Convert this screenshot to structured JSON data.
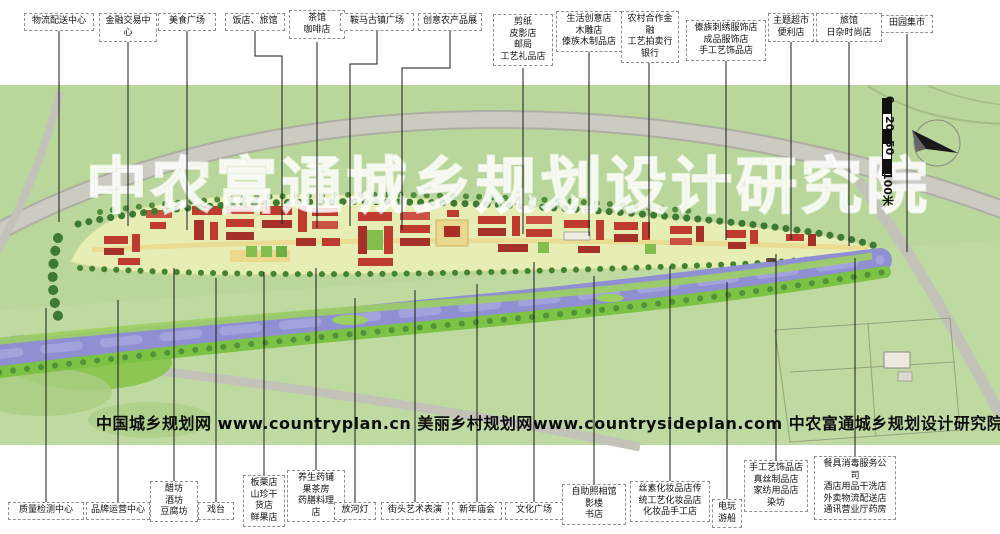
{
  "watermark": "中农富通城乡规划设计研究院",
  "credit": "中国城乡规划网 www.countryplan.cn  美丽乡村规划网www.countrysideplan.com  中农富通城乡规划设计研究院",
  "scale_bar": {
    "ticks": [
      "0",
      "20",
      "50",
      "100米"
    ]
  },
  "colors": {
    "map_green": "#b9d69b",
    "river_blue": "#8f8fd2",
    "building_red": "#bf3a2f",
    "road_gray": "#c9c9c0",
    "bank_green": "#7cc244"
  },
  "labels_top": [
    {
      "id": "logistics-center",
      "text": "物流配送中心"
    },
    {
      "id": "finance-trade-center",
      "text": "金融交易中心"
    },
    {
      "id": "food-plaza",
      "text": "美食广场"
    },
    {
      "id": "restaurant-hotel",
      "text": "饭店、旅馆"
    },
    {
      "id": "teahouse-cafe",
      "text": "茶馆\n咖啡店"
    },
    {
      "id": "ancient-town-plaza",
      "text": "鞍马古镇广场"
    },
    {
      "id": "creative-agri-expo",
      "text": "创意农产品展"
    },
    {
      "id": "papercut-shadow-shops",
      "text": "剪纸\n皮影店\n邮局\n工艺礼品店"
    },
    {
      "id": "life-creative-shops",
      "text": "生活创意店\n木雕店\n傣族木制品店"
    },
    {
      "id": "rural-finance-bank",
      "text": "农村合作金融\n工艺拍卖行\n银行"
    },
    {
      "id": "dai-embroidery-shops",
      "text": "傣族刺绣服饰店\n成品服饰店\n手工艺饰品店"
    },
    {
      "id": "theme-supermarket",
      "text": "主题超市\n便利店"
    },
    {
      "id": "hotel-daily-fashion",
      "text": "旅馆\n日杂时尚店"
    },
    {
      "id": "countryside-market",
      "text": "田园集市"
    }
  ],
  "labels_bottom": [
    {
      "id": "quality-inspection-center",
      "text": "质量检测中心"
    },
    {
      "id": "brand-operation-center",
      "text": "品牌运营中心"
    },
    {
      "id": "vinegar-wine-tofu-workshops",
      "text": "醋坊\n酒坊\n豆腐坊"
    },
    {
      "id": "opera-stage",
      "text": "戏台"
    },
    {
      "id": "chestnut-dried-goods-shops",
      "text": "板栗店\n山珍干\n货店\n鲜果店"
    },
    {
      "id": "herbal-health-shops",
      "text": "养生药铺\n果茶房\n药膳料理\n店"
    },
    {
      "id": "river-lanterns",
      "text": "放河灯"
    },
    {
      "id": "street-art-performance",
      "text": "街头艺术表演"
    },
    {
      "id": "new-year-temple-fair",
      "text": "新年庙会"
    },
    {
      "id": "culture-plaza",
      "text": "文化广场"
    },
    {
      "id": "photo-studio-bookstore",
      "text": "自助照相馆\n影楼\n书店"
    },
    {
      "id": "silk-cosmetics-shops",
      "text": "丝素化妆品店传\n统工艺化妆品店\n化妆品手工店"
    },
    {
      "id": "arcade-boats",
      "text": "电玩\n游船"
    },
    {
      "id": "handicraft-silk-shops",
      "text": "手工艺饰品店\n真丝制品店\n家纺用品店\n染坊"
    },
    {
      "id": "tableware-disinfect-services",
      "text": "餐具消毒服务公\n司\n酒店用品干洗店\n外卖物流配送店\n通讯营业厅药房"
    }
  ]
}
